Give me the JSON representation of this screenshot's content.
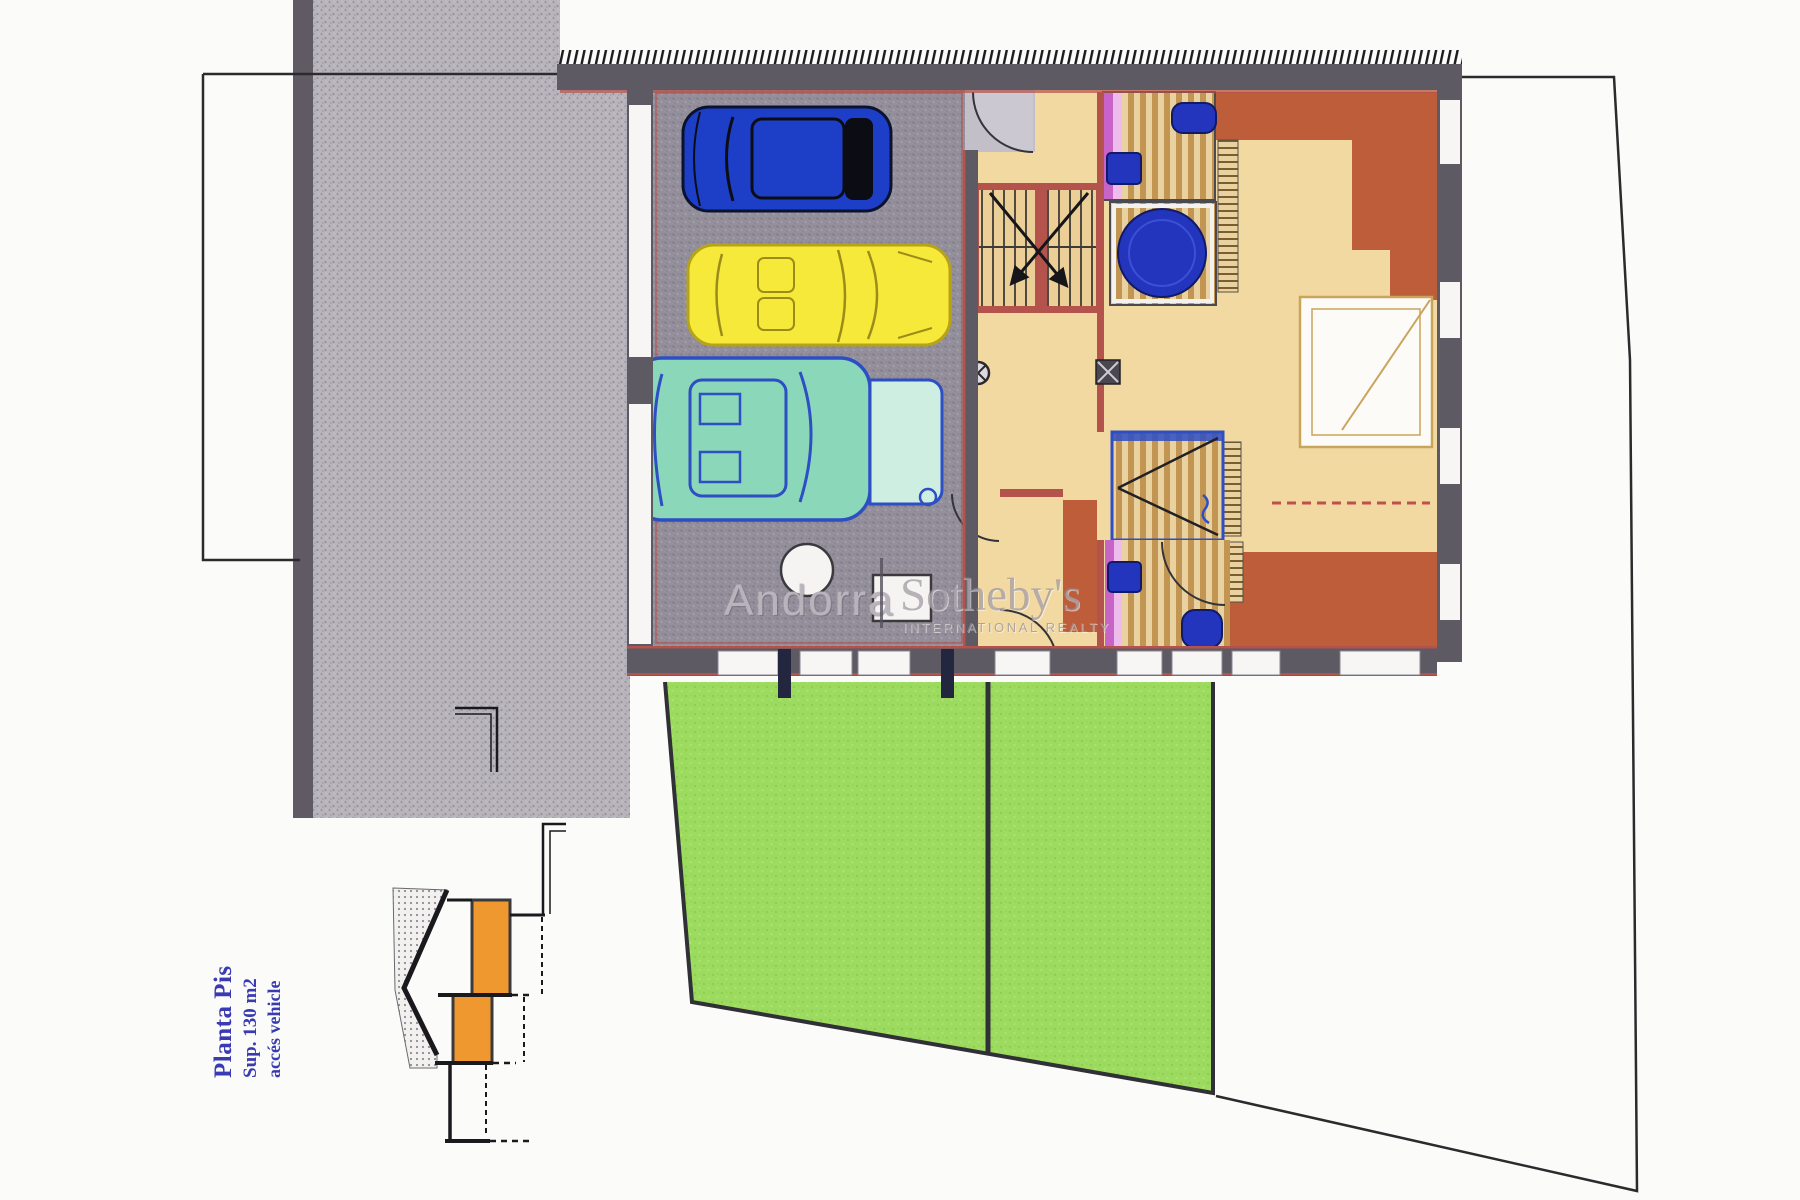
{
  "plan_label": {
    "title": "Planta Pis",
    "area": "Sup. 130 m2",
    "access": "accés vehicle"
  },
  "watermark": {
    "region": "Andorra",
    "brand": "Sotheby's",
    "tagline": "INTERNATIONAL REALTY"
  },
  "colors": {
    "page_bg": "#fbfbf9",
    "boundary": "#2b2b2e",
    "driveway": "#b8b4bc",
    "driveway_edge": "#5f5a64",
    "garage_floor": "#94909b",
    "wall_dark": "#5d5a64",
    "wall_red": "#b4524c",
    "tan": "#f2d8a1",
    "wood_dark": "#c29552",
    "terracotta": "#bd5d3a",
    "purple": "#c863c8",
    "purple_light": "#edbcec",
    "fixture_blue": "#2334bd",
    "lawn": "#9cdb60",
    "lawn_border": "#303036",
    "car_blue": "#1d3fc8",
    "car_yellow": "#f6e93a",
    "car_teal": "#8ad7b9",
    "car_teal_line": "#2e4fc4",
    "section_orange": "#ef9830",
    "title_text": "#3a3ab2"
  }
}
